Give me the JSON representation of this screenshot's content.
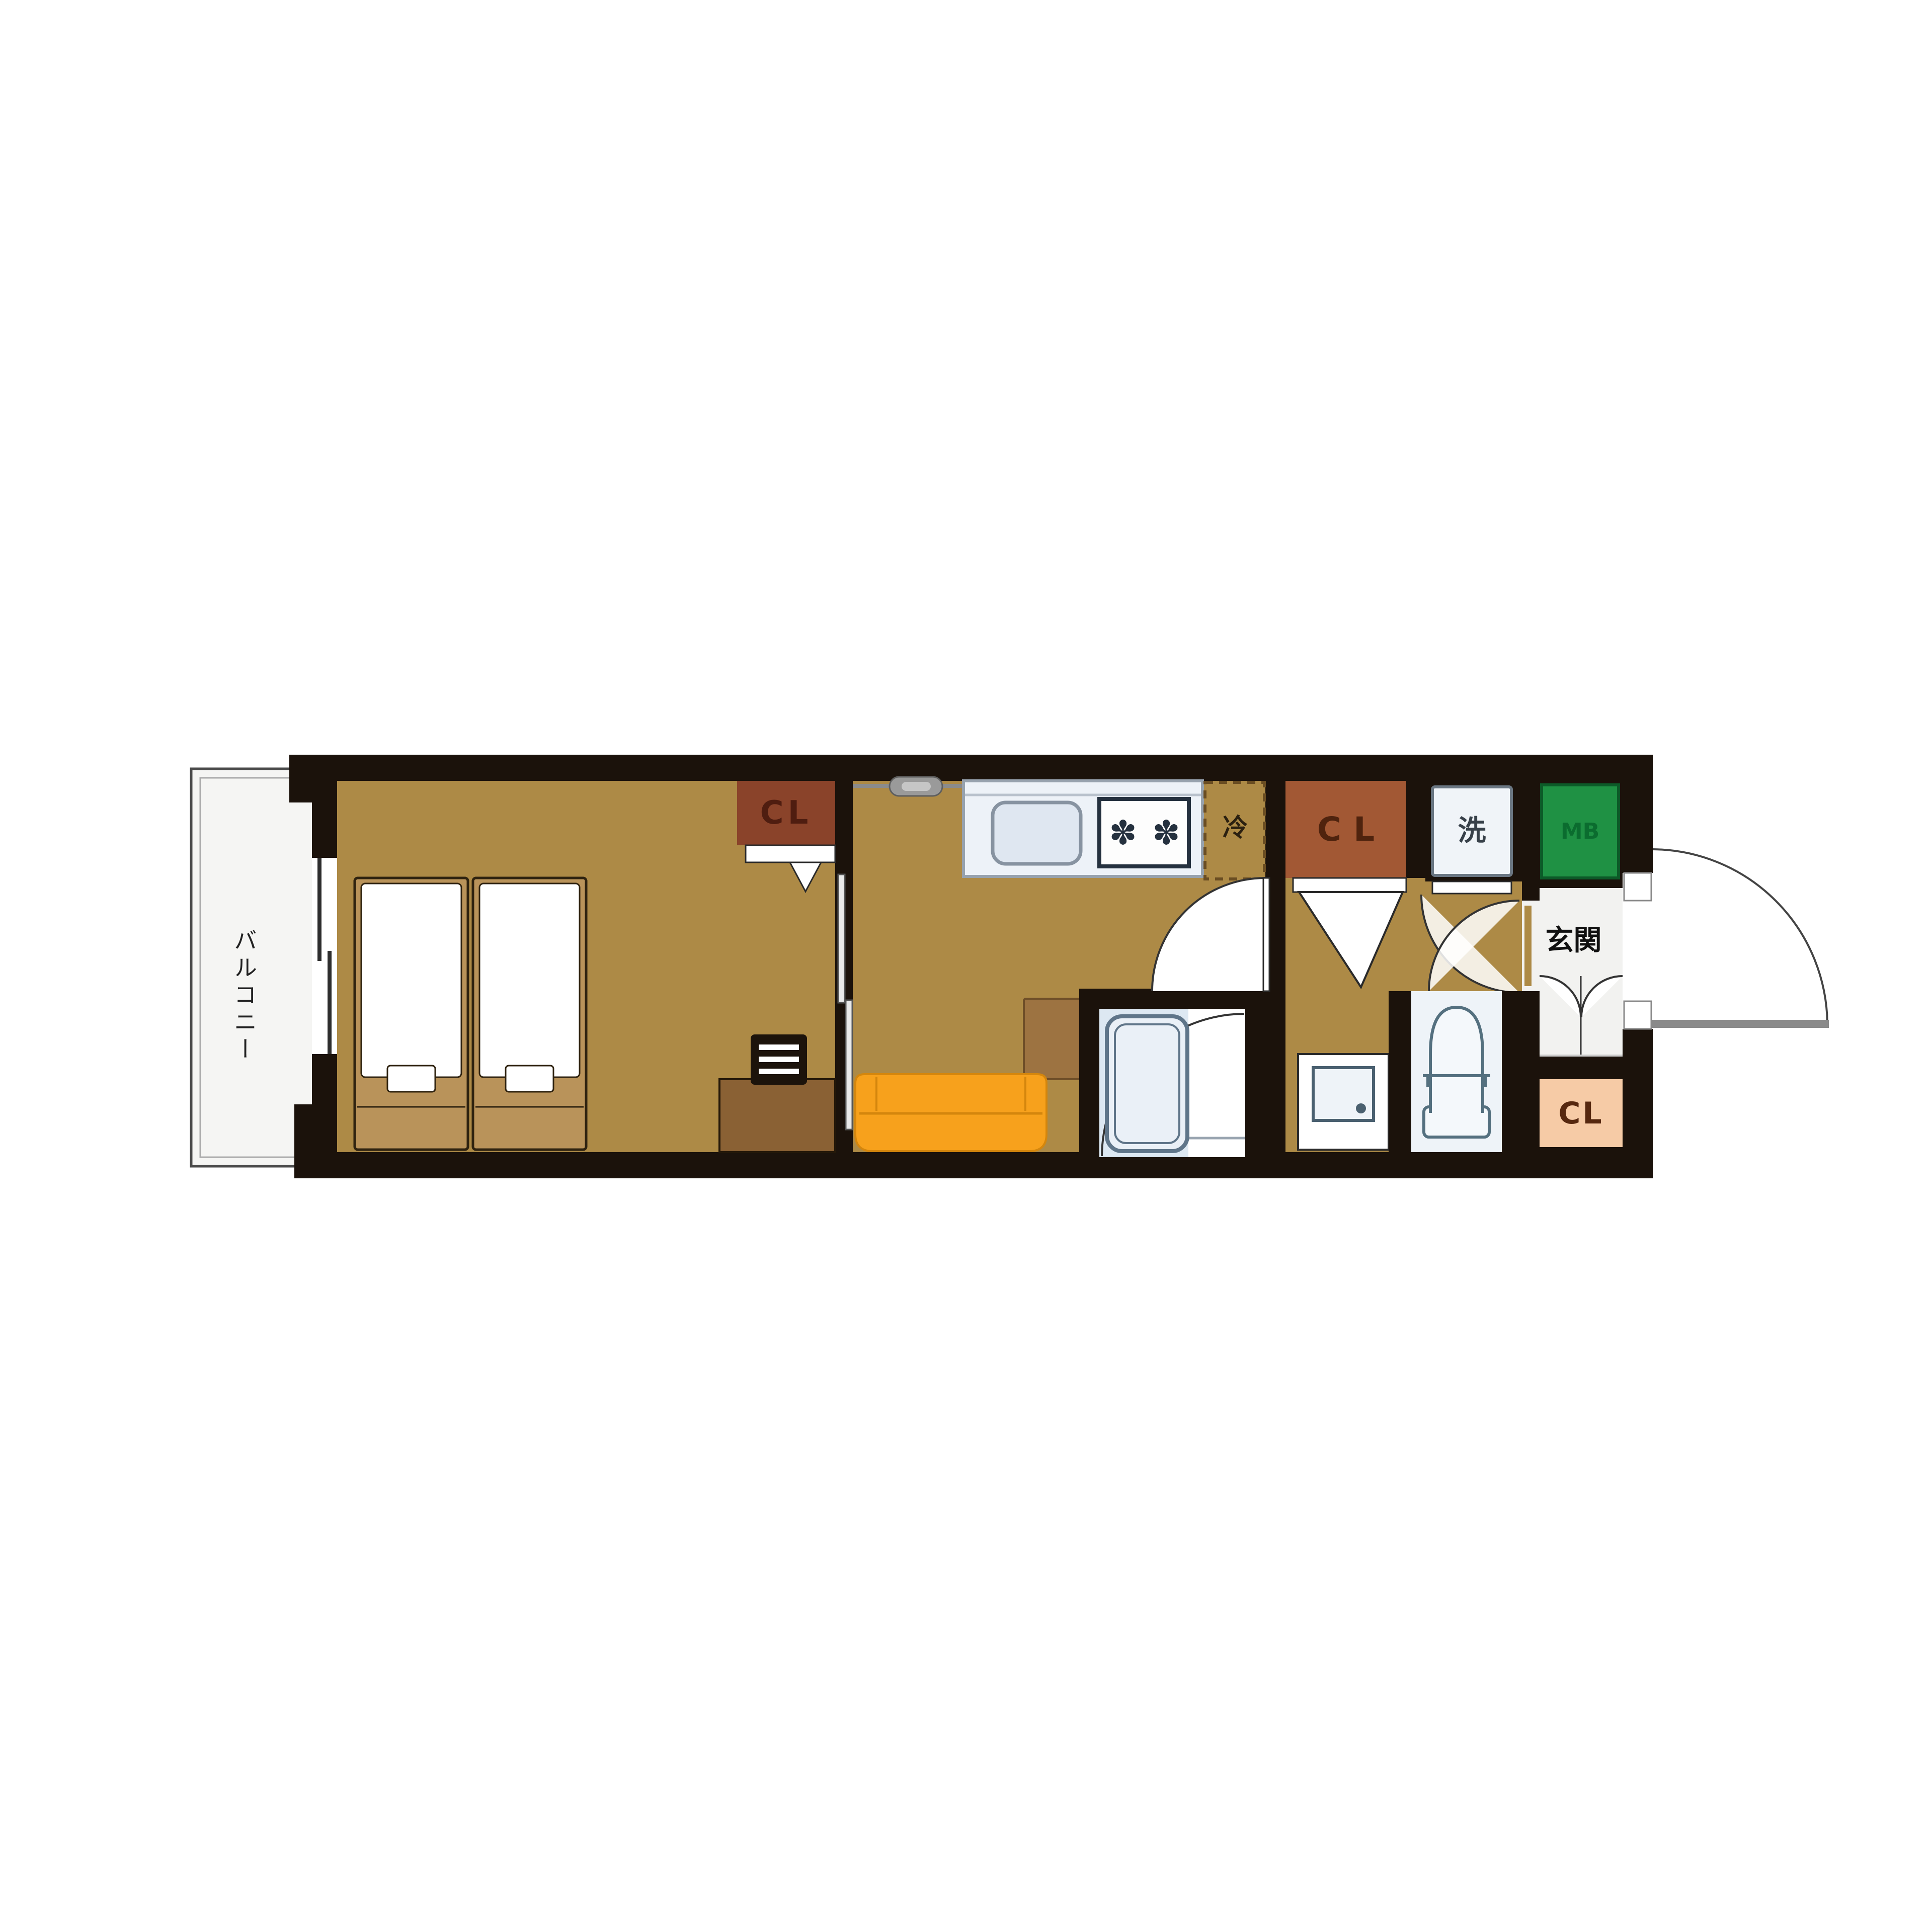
{
  "page": {
    "background_color": "#ffffff",
    "type": "apartment-floor-plan"
  },
  "floorplan": {
    "rooms": {
      "balcony": {
        "label": "バルコニー"
      },
      "bedroom": {
        "closet_label": "CL"
      },
      "kitchen_living": {
        "fridge_label": "冷"
      },
      "hall": {
        "closet_label": "CL",
        "washer_label": "洗",
        "meter_box_label": "MB"
      },
      "entrance": {
        "label": "玄関",
        "closet_label": "CL"
      }
    },
    "icons": {
      "burner": "✽"
    },
    "colors": {
      "wall": "#1b120b",
      "floor": "#ad8a46",
      "balcony_floor": "#f5f5f3",
      "bedroom_closet": "#8a432a",
      "hall_closet": "#a25834",
      "entrance_closet": "#f6cba6",
      "meter_box": "#1f9144",
      "sofa": "#f7a11c",
      "table": "#9d7341",
      "desk": "#8a6134",
      "bed_frame": "#b9935a",
      "kitchen_counter": "#edf2f8",
      "bath_floor": "#dde8f2",
      "toilet_floor": "#eef3f8",
      "fixture_stroke": "#5f7589"
    }
  }
}
